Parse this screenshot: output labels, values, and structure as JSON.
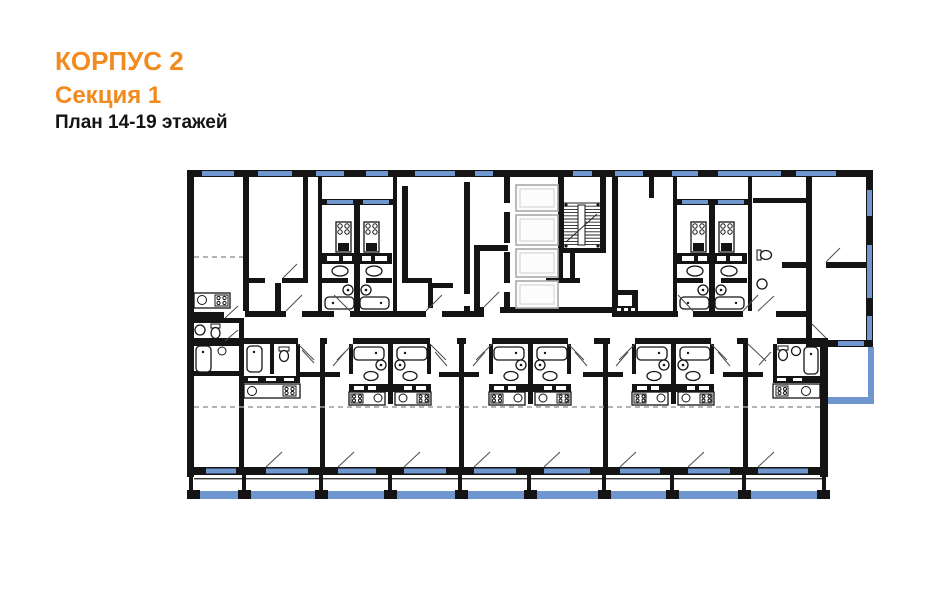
{
  "header": {
    "building": "КОРПУС 2",
    "section": "Секция 1",
    "plan_label": "План 14-19 этажей"
  },
  "plan": {
    "building": "КОРПУС 2",
    "section": "Секция 1",
    "floors": "14-19",
    "colors": {
      "background": "#ffffff",
      "accent_orange": "#f18a1f",
      "text": "#141414",
      "wall_black": "#141414",
      "window_blue": "#6f96cf",
      "dashed_gray": "#9b9b9b",
      "elevator_gray": "#a9a9a9"
    },
    "elements": {
      "elevator_shafts": 4,
      "staircase": 1,
      "central_corridor": 1,
      "balcony_band_bottom": 1,
      "balcony_right_side": 1,
      "bathtubs": 12,
      "kitchen_blocks": 10
    }
  }
}
